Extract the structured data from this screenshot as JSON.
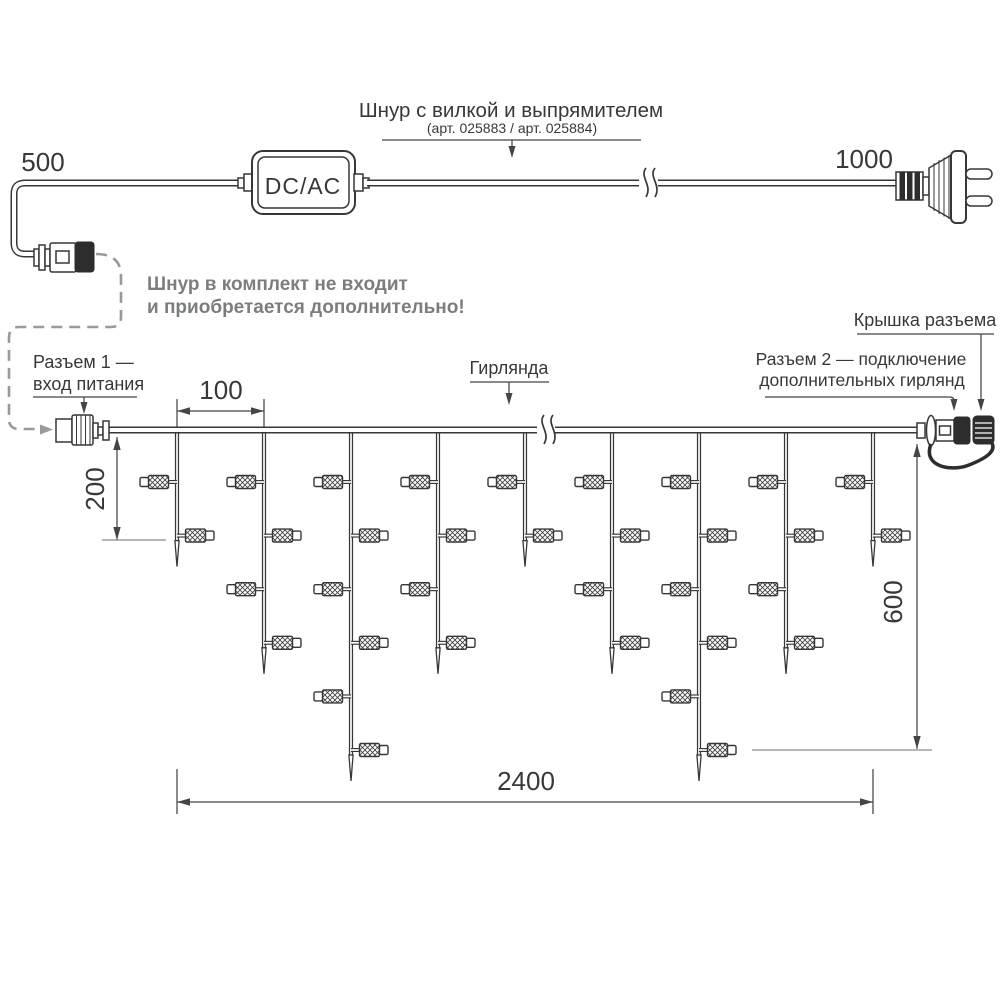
{
  "labels": {
    "cord_title": "Шнур с вилкой и выпрямителем",
    "cord_articles": "(арт. 025883 / арт. 025884)",
    "adapter": "DC/AC",
    "not_included_line1": "Шнур в комплект не входит",
    "not_included_line2": "и приобретается дополнительно!",
    "connector1_line1": "Разъем 1 —",
    "connector1_line2": "вход питания",
    "garland": "Гирлянда",
    "connector2_line1": "Разъем 2 — подключение",
    "connector2_line2": "дополнительных гирлянд",
    "cap": "Крышка разъема"
  },
  "dimensions": {
    "cord_left": "500",
    "cord_right": "1000",
    "drop_spacing": "100",
    "first_drop": "200",
    "max_drop": "600",
    "total_length": "2400"
  },
  "garland": {
    "drop_count": 9,
    "lamp_counts_per_drop": [
      2,
      4,
      6,
      4,
      2,
      4,
      6,
      4,
      2
    ],
    "lamp_total": 34
  },
  "colors": {
    "line": "#373737",
    "dim_line": "#454545",
    "gray_leader": "#9a9a9a",
    "gray_ref": "#8a8a8a",
    "gray_text": "#7b7e80",
    "background": "#ffffff"
  }
}
